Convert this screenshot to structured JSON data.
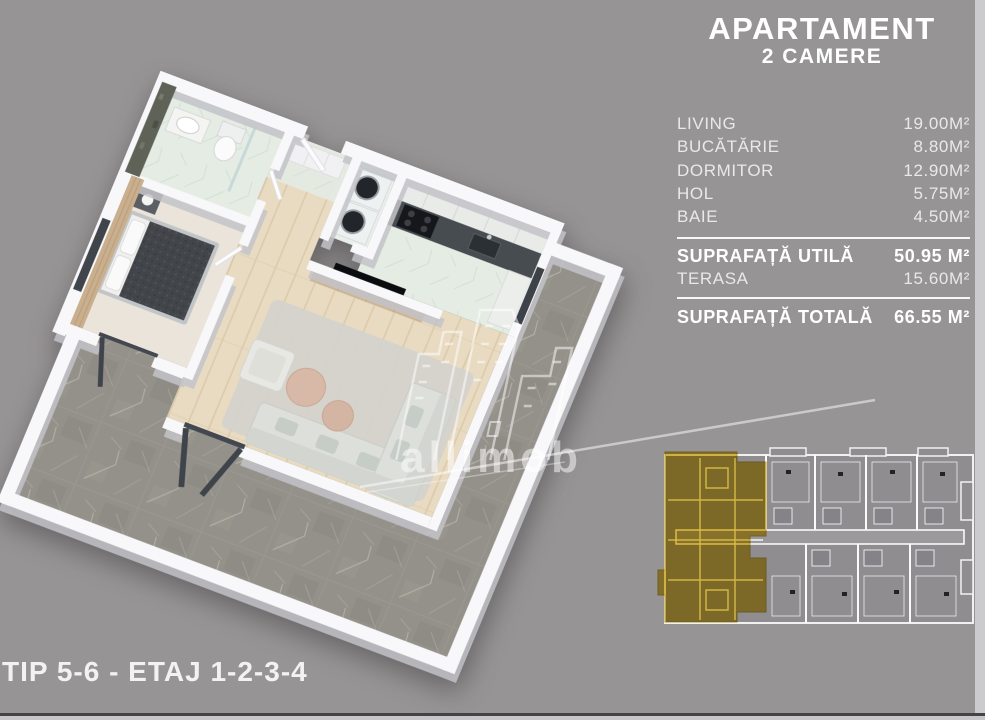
{
  "panel": {
    "title_line1": "APARTAMENT",
    "title_line2": "2 CAMERE",
    "rooms": [
      {
        "label": "LIVING",
        "area": "19.00M²"
      },
      {
        "label": "BUCĂTĂRIE",
        "area": "8.80M²"
      },
      {
        "label": "DORMITOR",
        "area": "12.90M²"
      },
      {
        "label": "HOL",
        "area": "5.75M²"
      },
      {
        "label": "BAIE",
        "area": "4.50M²"
      }
    ],
    "summary": {
      "utila": {
        "label": "SUPRAFAȚĂ UTILĂ",
        "area": "50.95 M²"
      },
      "terasa": {
        "label": "TERASA",
        "area": "15.60M²"
      },
      "totala": {
        "label": "SUPRAFAȚĂ TOTALĂ",
        "area": "66.55 M²"
      }
    }
  },
  "footer": {
    "type_label": "TIP 5-6 - ETAJ 1-2-3-4"
  },
  "watermark": {
    "brand": "allimob"
  },
  "colors": {
    "background": "#979495",
    "panel_text": "#ffffff",
    "highlight_yellow": "#d9b631",
    "terrace_marble": "#94908a",
    "mint_floor": "#e4ece4",
    "wood_floor": "#e8dbc2",
    "site_plan_lines": "#f2f1f2"
  }
}
